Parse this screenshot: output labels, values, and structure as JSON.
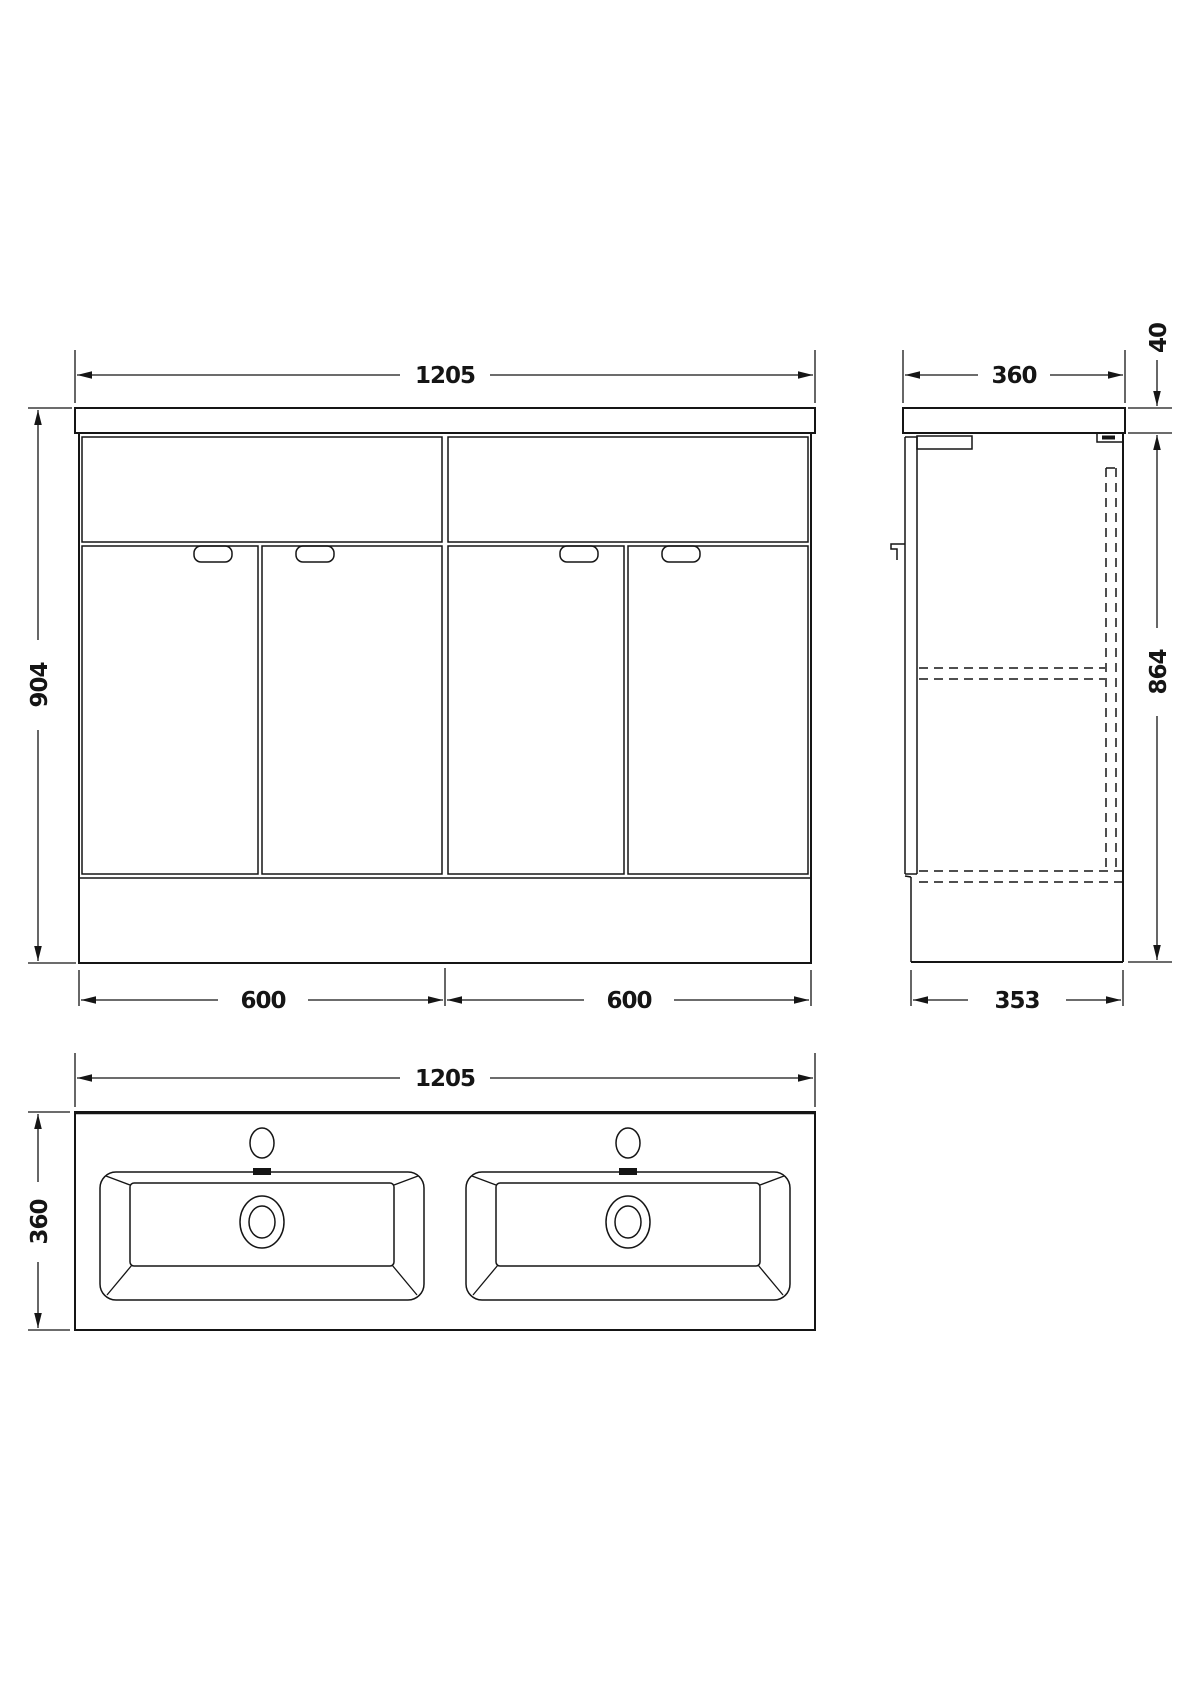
{
  "drawing_title": "vanity-unit-dimension-drawing",
  "colors": {
    "line": "#151515",
    "background": "#ffffff"
  },
  "front_view": {
    "width_mm": "1205",
    "height_mm": "904",
    "left_unit_mm": "600",
    "right_unit_mm": "600"
  },
  "side_view": {
    "depth_mm": "360",
    "worktop_thickness_mm": "40",
    "cabinet_height_mm": "864",
    "base_depth_mm": "353"
  },
  "plan_view": {
    "width_mm": "1205",
    "depth_mm": "360"
  }
}
